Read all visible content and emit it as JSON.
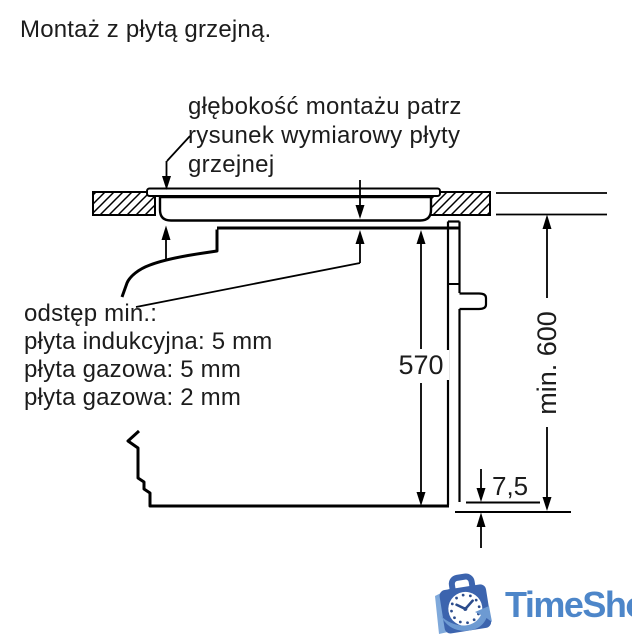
{
  "title": "Montaż z płytą grzejną.",
  "depth_note": {
    "line1": "głębokość montażu patrz",
    "line2": "rysunek wymiarowy płyty",
    "line3": "grzejnej"
  },
  "clearance_note": {
    "line1": "odstęp min.:",
    "line2": "płyta indukcyjna: 5 mm",
    "line3": "płyta gazowa: 5 mm",
    "line4": "płyta gazowa: 2 mm"
  },
  "dimensions": {
    "oven_niche_height": "570",
    "min_clearance_height": "min. 600",
    "bottom_gap": "7,5"
  },
  "logo": {
    "text": "TimeShop",
    "icon": "clock-shopping-bag-icon",
    "text_color": "#4d86c9",
    "bag_color": "#3c64ae",
    "accent_color": "#6d9ad2"
  },
  "diagram": {
    "line_color": "#000000",
    "background_color": "#ffffff"
  }
}
